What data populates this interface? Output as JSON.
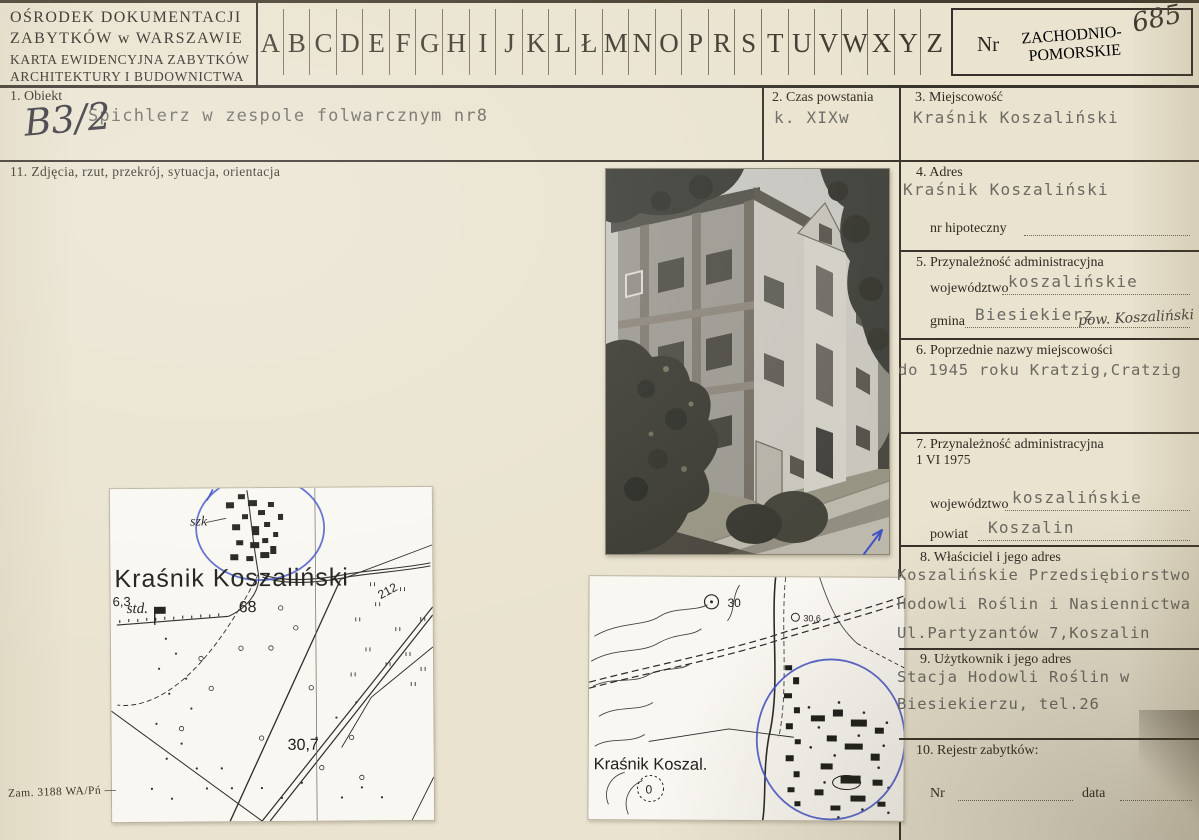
{
  "card": {
    "org1": "OŚRODEK DOKUMENTACJI",
    "org2": "ZABYTKÓW w WARSZAWIE",
    "title1": "KARTA EWIDENCYJNA ZABYTKÓW",
    "title2": "ARCHITEKTURY I BUDOWNICTWA"
  },
  "index": {
    "letters": [
      "A",
      "B",
      "C",
      "D",
      "E",
      "F",
      "G",
      "H",
      "I",
      "J",
      "K",
      "L",
      "Ł",
      "M",
      "N",
      "O",
      "P",
      "R",
      "S",
      "T",
      "U",
      "V",
      "W",
      "X",
      "Y",
      "Z"
    ]
  },
  "nr_box": {
    "label": "Nr",
    "stamp1": "ZACHODNIO-",
    "stamp2": "POMORSKIE",
    "number": "685"
  },
  "f1": {
    "label": "1. Obiekt",
    "value": "Spichlerz w zespole folwarcznym nr8",
    "note": "B3/2"
  },
  "f2": {
    "label": "2. Czas powstania",
    "value": "k. XIXw"
  },
  "f3": {
    "label": "3. Miejscowość",
    "value": "Kraśnik Koszaliński"
  },
  "f4": {
    "label": "4. Adres",
    "value": "Kraśnik Koszaliński",
    "hipoteczny_label": "nr hipoteczny"
  },
  "f5": {
    "label": "5. Przynależność administracyjna",
    "woj_label": "województwo",
    "woj": "koszalińskie",
    "gmina_label": "gmina",
    "gmina": "Biesiekierz",
    "note": "pow. Koszaliński"
  },
  "f6": {
    "label": "6. Poprzednie nazwy miejscowości",
    "value": "do 1945 roku Kratzig,Cratzig"
  },
  "f7": {
    "label": "7. Przynależność administracyjna",
    "label2": "1 VI 1975",
    "woj_label": "województwo",
    "woj": "koszalińskie",
    "powiat_label": "powiat",
    "powiat": "Koszalin"
  },
  "f8": {
    "label": "8. Właściciel i jego adres",
    "line1": "Koszalińskie Przedsiębiorstwo",
    "line2": "Hodowli Roślin i Nasiennictwa",
    "line3": "Ul.Partyzantów 7,Koszalin"
  },
  "f9": {
    "label": "9. Użytkownik i jego adres",
    "line1": "Stacja Hodowli Roślin w",
    "line2": "Biesiekierzu, tel.26"
  },
  "f10": {
    "label": "10. Rejestr zabytków:",
    "nr_label": "Nr",
    "data_label": "data"
  },
  "f11": {
    "label": "11. Zdjęcia, rzut, przekrój, sytuacja, orientacja"
  },
  "map_left": {
    "std": "std.",
    "szk": "szk",
    "town": "Kraśnik Koszaliński",
    "h1": "6,3",
    "h2": "68",
    "h3": "212",
    "h4": "30,7"
  },
  "map_bottom": {
    "town": "Kraśnik Koszal.",
    "h1": "30",
    "h2": "30,6",
    "h3": "0"
  },
  "footer": {
    "print_note": "Zam. 3188 WA/Pń —"
  },
  "colors": {
    "card_bg": "#e9e3cf",
    "rule_ink": "#37322a",
    "printed_ink": "#2e2a21",
    "typed_ink": "#6b6962",
    "handwriting_ink": "#3a3730",
    "annotation_blue": "#4053c4",
    "map_paper": "#f9f7f1"
  }
}
